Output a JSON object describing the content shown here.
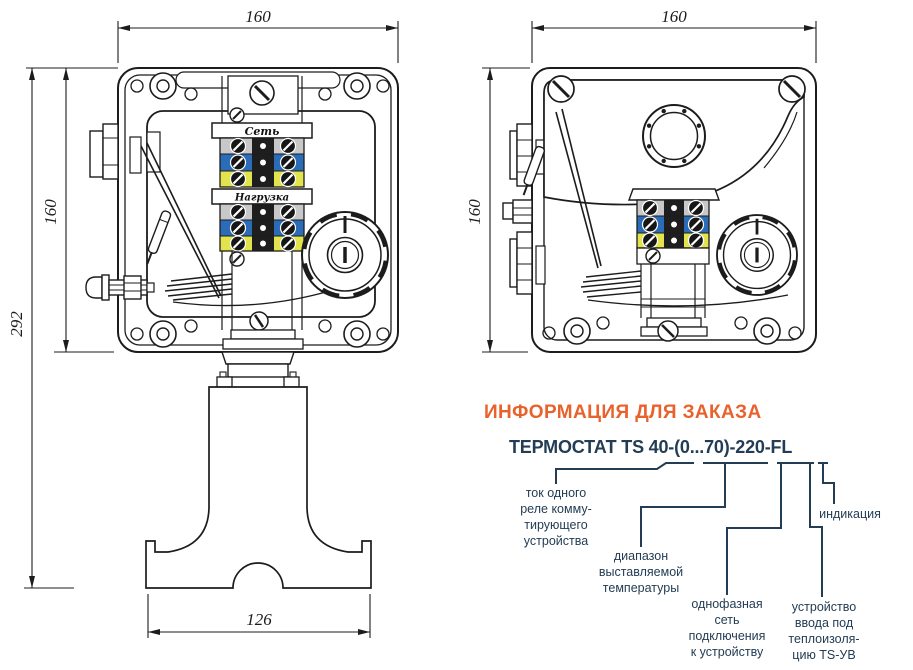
{
  "colors": {
    "accent_orange": "#e8622c",
    "navy_text": "#233d54",
    "line_dark": "#1c1c1c",
    "terminal_grey": "#c8c8c8",
    "terminal_blue": "#2b6cb8",
    "terminal_yellow": "#e2e34d"
  },
  "left_view": {
    "dim_width_top": "160",
    "dim_height": "160",
    "dim_height_total": "292",
    "dim_width_base": "126",
    "terminal_top_label": "Сеть",
    "terminal_bottom_label": "Нагрузка"
  },
  "right_view": {
    "dim_width_top": "160",
    "dim_height": "160"
  },
  "order_info": {
    "heading": "ИНФОРМАЦИЯ ДЛЯ ЗАКАЗА",
    "code": "ТЕРМОСТАТ TS 40-(0...70)-220-FL",
    "callouts": {
      "relay_current": "ток одного\nреле комму-\nтирующего\nустройства",
      "temperature_range": "диапазон\nвыставляемой\nтемпературы",
      "mains_connection": "однофазная\nсеть\nподключения\nк устройству",
      "entry_device": "устройство\nввода под\nтеплоизоля-\nцию TS-УВ",
      "indication": "индикация"
    }
  }
}
